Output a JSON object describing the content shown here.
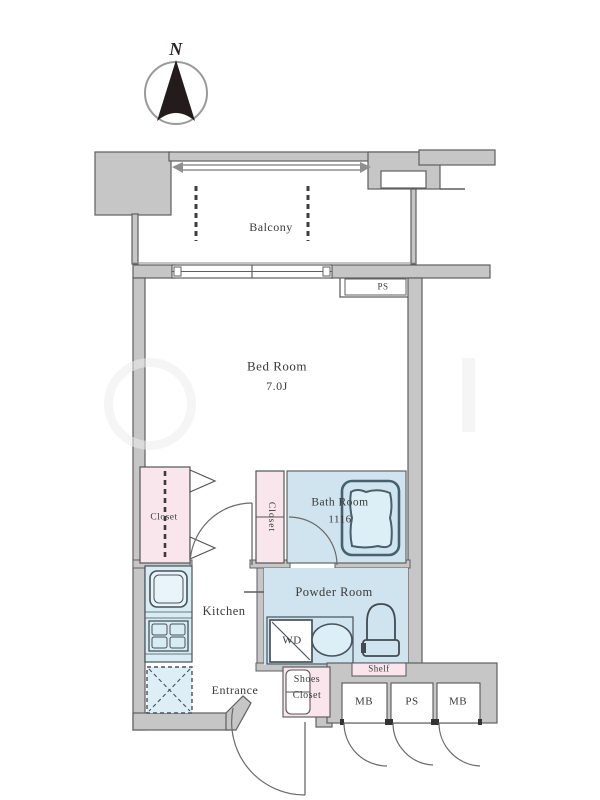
{
  "compass": {
    "north": "N"
  },
  "labels": {
    "balcony": "Balcony",
    "ps_top": "PS",
    "bedroom_name": "Bed Room",
    "bedroom_size": "7.0J",
    "closet_left": "Closet",
    "closet_mid": "Closet",
    "bathroom_name": "Bath Room",
    "bathroom_size": "1116",
    "kitchen": "Kitchen",
    "powder_room": "Powder Room",
    "wd": "WD",
    "shelf": "Shelf",
    "entrance": "Entrance",
    "shoes_line1": "Shoes",
    "shoes_line2": "Closet",
    "mb_left": "MB",
    "ps_bottom": "PS",
    "mb_right": "MB"
  },
  "colors": {
    "wall_fill": "#c6c6c6",
    "wall_edge": "#5f5f5f",
    "closet_pink": "#f9e6ec",
    "wet_area_blue": "#cfe4ef",
    "fixture_blue": "#dceef6",
    "fixture_line": "#47525a",
    "text": "#3a3a3a"
  }
}
